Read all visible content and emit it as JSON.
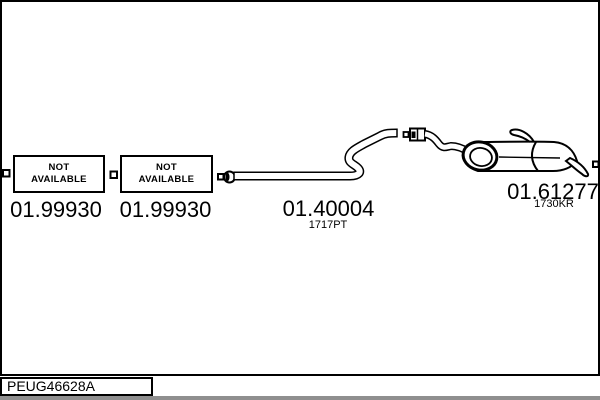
{
  "colors": {
    "ink": "#000000",
    "paper": "#ffffff",
    "footer_strip": "#8f8f8f"
  },
  "parts": {
    "front_section_1": {
      "status_line1": "NOT",
      "status_line2": "AVAILABLE",
      "number": "01.99930"
    },
    "front_section_2": {
      "status_line1": "NOT",
      "status_line2": "AVAILABLE",
      "number": "01.99930"
    },
    "center_pipe": {
      "number": "01.40004",
      "variant_code": "1717PT"
    },
    "rear_silencer": {
      "number": "01.61277",
      "variant_code": "1730KR"
    }
  },
  "footer": {
    "reference_code": "PEUG46628A"
  }
}
